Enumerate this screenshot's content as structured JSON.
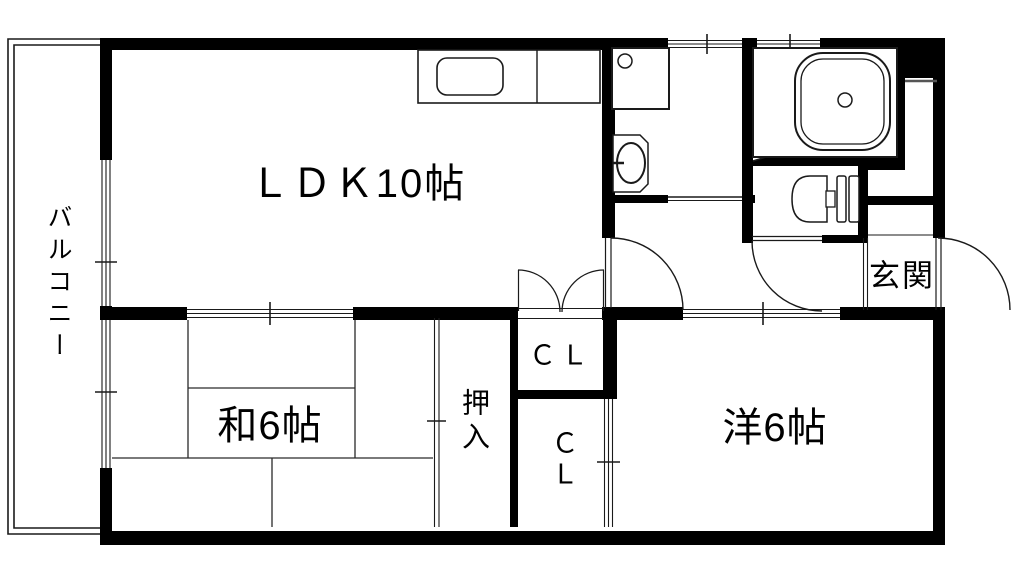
{
  "rooms": {
    "balcony": {
      "label": "バルコニー"
    },
    "ldk": {
      "label": "ＬＤＫ10帖"
    },
    "japanese_room": {
      "label": "和6帖"
    },
    "western_room": {
      "label": "洋6帖"
    },
    "entrance": {
      "label": "玄関"
    },
    "oshiire": {
      "label": "押入"
    },
    "closet_upper": {
      "label": "ＣＬ"
    },
    "closet_lower": {
      "label": "ＣＬ"
    }
  },
  "colors": {
    "wall": "#000000",
    "line": "#1a1a1a",
    "background": "#ffffff"
  }
}
